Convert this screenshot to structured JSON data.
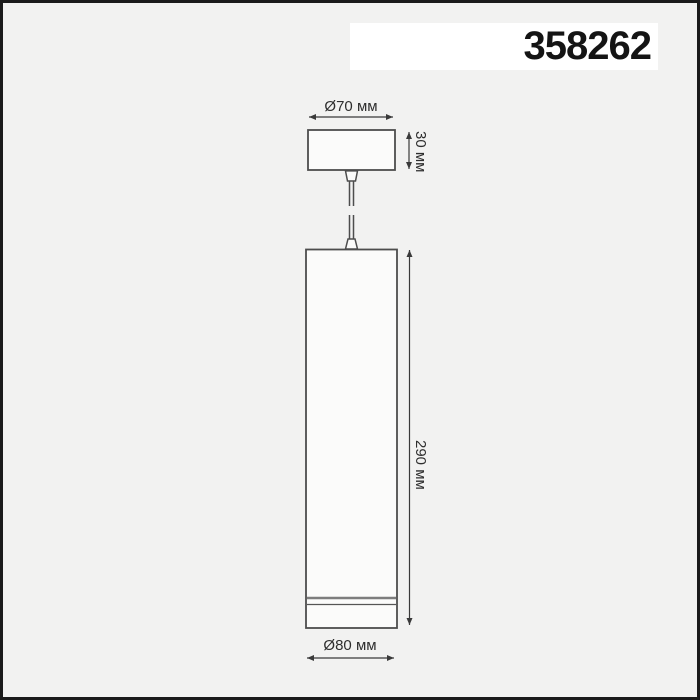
{
  "product": {
    "code": "358262"
  },
  "dimensions": {
    "canopy_diameter": "Ø70 мм",
    "canopy_height": "30 мм",
    "body_height": "290 мм",
    "body_diameter": "Ø80 мм"
  },
  "colors": {
    "background": "#f2f2f1",
    "frame_border": "#1b1b1b",
    "drawing_line": "#4d4d4d",
    "dimension_line": "#3a3a3a",
    "code_band_background": "#ffffff",
    "code_text": "#141414",
    "label_text": "#2e2e2e"
  }
}
